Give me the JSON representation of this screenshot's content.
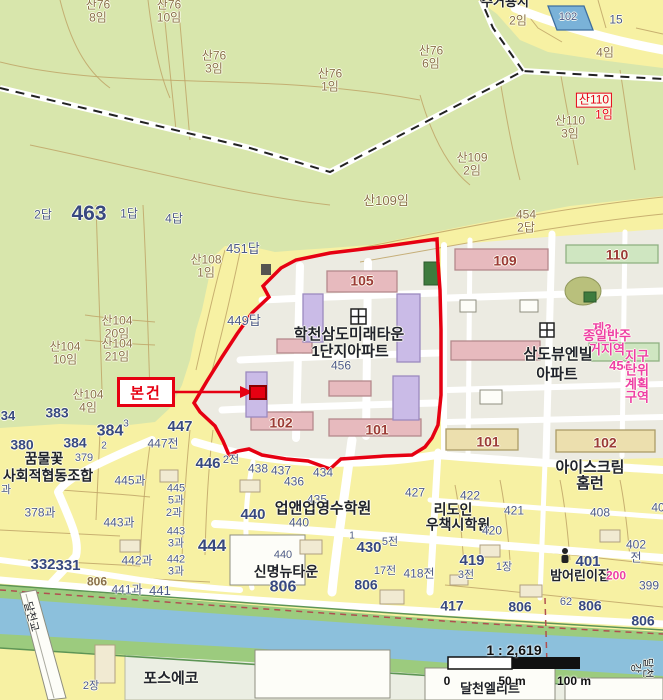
{
  "subject_marker": {
    "label": "본건"
  },
  "scale": {
    "ratio": "1 : 2,619",
    "ticks": [
      "0",
      "50 m",
      "100 m"
    ]
  },
  "colors": {
    "urban": "#f7f1a3",
    "forest": "#d8e6ac",
    "ground": "#ecebe2",
    "road": "#ffffff",
    "parcel_line": "#bfa567",
    "river": "#8cc0dc",
    "bank": "#9ccb7e",
    "industrial": "#ebeee3",
    "boundary_red": "#e60012",
    "building_pink": "#e7babe",
    "building_purple": "#cabbe7",
    "building_green": "#cfe6c1",
    "building_tan": "#ecdfae",
    "building_darkgreen": "#3e7b3e",
    "building_blue": "#7ab2d8",
    "label_blue": "#38497f",
    "label_blue_small": "#4d5a88",
    "label_brown": "#8a7049",
    "label_black": "#20232b",
    "label_red": "#e60012",
    "label_pink": "#ee3fa5",
    "label_building": "#9b3b36"
  },
  "map_labels": [
    {
      "t": "산76\n8임",
      "x": 98,
      "y": 11,
      "c": "brown"
    },
    {
      "t": "산76\n10임",
      "x": 169,
      "y": 11,
      "c": "brown"
    },
    {
      "t": "주거용지",
      "x": 505,
      "y": 2,
      "c": "black",
      "b": 1,
      "s": 13
    },
    {
      "t": "2임",
      "x": 518,
      "y": 21,
      "c": "brown"
    },
    {
      "t": "102",
      "x": 568,
      "y": 18,
      "c": "bluesm",
      "s": 11
    },
    {
      "t": "15",
      "x": 616,
      "y": 20,
      "c": "bluesm",
      "s": 12
    },
    {
      "t": "4임",
      "x": 605,
      "y": 53,
      "c": "brown"
    },
    {
      "t": "산76\n6임",
      "x": 431,
      "y": 57,
      "c": "brown"
    },
    {
      "t": "산76\n3임",
      "x": 214,
      "y": 62,
      "c": "brown"
    },
    {
      "t": "산76\n1임",
      "x": 330,
      "y": 80,
      "c": "brown"
    },
    {
      "t": "산110",
      "x": 594,
      "y": 100,
      "c": "red",
      "box": 1,
      "s": 12
    },
    {
      "t": "1임",
      "x": 604,
      "y": 115,
      "c": "red",
      "s": 12
    },
    {
      "t": "산110\n3임",
      "x": 570,
      "y": 127,
      "c": "brown"
    },
    {
      "t": "산109\n2임",
      "x": 472,
      "y": 164,
      "c": "brown"
    },
    {
      "t": "산109임",
      "x": 386,
      "y": 201,
      "c": "brown",
      "s": 13
    },
    {
      "t": "2답",
      "x": 43,
      "y": 215,
      "c": "bluesm"
    },
    {
      "t": "463",
      "x": 89,
      "y": 214,
      "c": "blue",
      "b": 1,
      "s": 21
    },
    {
      "t": "1답",
      "x": 129,
      "y": 214,
      "c": "bluesm"
    },
    {
      "t": "4답",
      "x": 174,
      "y": 219,
      "c": "bluesm"
    },
    {
      "t": "454\n2답",
      "x": 526,
      "y": 221,
      "c": "brown"
    },
    {
      "t": "451답",
      "x": 243,
      "y": 249,
      "c": "bluesm",
      "s": 13
    },
    {
      "t": "산108\n1임",
      "x": 206,
      "y": 266,
      "c": "brown"
    },
    {
      "t": "449답",
      "x": 244,
      "y": 321,
      "c": "bluesm",
      "s": 13
    },
    {
      "t": "105",
      "x": 362,
      "y": 281,
      "c": "bldg",
      "b": 1,
      "s": 14
    },
    {
      "t": "109",
      "x": 505,
      "y": 261,
      "c": "bldg",
      "b": 1,
      "s": 14
    },
    {
      "t": "110",
      "x": 617,
      "y": 255,
      "c": "bldg",
      "b": 1,
      "s": 14
    },
    {
      "t": "학천삼도미래타운",
      "x": 349,
      "y": 335,
      "c": "black",
      "b": 1,
      "s": 15
    },
    {
      "t": "1단지아파트",
      "x": 350,
      "y": 352,
      "c": "black",
      "b": 1,
      "s": 15
    },
    {
      "t": "456",
      "x": 341,
      "y": 366,
      "c": "bluesm"
    },
    {
      "t": "산104\n20임",
      "x": 117,
      "y": 327,
      "c": "brown"
    },
    {
      "t": "산104\n21임",
      "x": 117,
      "y": 350,
      "c": "brown"
    },
    {
      "t": "산104\n10임",
      "x": 65,
      "y": 353,
      "c": "brown"
    },
    {
      "t": "제3",
      "x": 602,
      "y": 329,
      "c": "pink",
      "b": 1,
      "s": 13
    },
    {
      "t": "종일반주거지역",
      "x": 607,
      "y": 343,
      "c": "pink",
      "b": 1,
      "s": 13
    },
    {
      "t": "삼도뷰엔빌",
      "x": 558,
      "y": 355,
      "c": "black",
      "b": 1,
      "s": 15
    },
    {
      "t": "454",
      "x": 620,
      "y": 366,
      "c": "pink",
      "b": 1,
      "s": 13
    },
    {
      "t": "아파트",
      "x": 557,
      "y": 375,
      "c": "black",
      "b": 1,
      "s": 15
    },
    {
      "t": "지구단위계획구역",
      "x": 637,
      "y": 377,
      "c": "pink",
      "b": 1,
      "s": 13
    },
    {
      "t": "산104\n4임",
      "x": 88,
      "y": 401,
      "c": "brown"
    },
    {
      "t": "34",
      "x": 8,
      "y": 416,
      "c": "blue",
      "b": 1,
      "s": 13
    },
    {
      "t": "383",
      "x": 57,
      "y": 413,
      "c": "blue",
      "b": 1,
      "s": 14
    },
    {
      "t": "384",
      "x": 110,
      "y": 432,
      "c": "blue",
      "b": 1,
      "s": 16
    },
    {
      "t": "3",
      "x": 126,
      "y": 425,
      "c": "bluesm",
      "s": 10
    },
    {
      "t": "2",
      "x": 104,
      "y": 447,
      "c": "bluesm",
      "s": 10
    },
    {
      "t": "380",
      "x": 22,
      "y": 445,
      "c": "blue",
      "b": 1,
      "s": 14
    },
    {
      "t": "384",
      "x": 75,
      "y": 443,
      "c": "blue",
      "b": 1,
      "s": 14
    },
    {
      "t": "447",
      "x": 180,
      "y": 427,
      "c": "blue",
      "b": 1,
      "s": 15
    },
    {
      "t": "447전",
      "x": 163,
      "y": 444,
      "c": "bluesm"
    },
    {
      "t": "446",
      "x": 208,
      "y": 464,
      "c": "blue",
      "b": 1,
      "s": 15
    },
    {
      "t": "2전",
      "x": 231,
      "y": 461,
      "c": "bluesm",
      "s": 11
    },
    {
      "t": "438",
      "x": 258,
      "y": 469,
      "c": "bluesm"
    },
    {
      "t": "437",
      "x": 281,
      "y": 471,
      "c": "bluesm"
    },
    {
      "t": "436",
      "x": 294,
      "y": 482,
      "c": "bluesm"
    },
    {
      "t": "434",
      "x": 323,
      "y": 473,
      "c": "bluesm"
    },
    {
      "t": "435",
      "x": 317,
      "y": 500,
      "c": "bluesm"
    },
    {
      "t": "꿈물꽃",
      "x": 44,
      "y": 459,
      "c": "black",
      "b": 1,
      "s": 14
    },
    {
      "t": "379",
      "x": 84,
      "y": 459,
      "c": "bluesm",
      "s": 11
    },
    {
      "t": "사회적협동조합",
      "x": 48,
      "y": 476,
      "c": "black",
      "b": 1,
      "s": 14
    },
    {
      "t": "445과",
      "x": 130,
      "y": 481,
      "c": "bluesm"
    },
    {
      "t": "과",
      "x": 6,
      "y": 491,
      "c": "bluesm",
      "s": 11
    },
    {
      "t": "445\n5과",
      "x": 176,
      "y": 495,
      "c": "bluesm",
      "s": 11
    },
    {
      "t": "2과",
      "x": 174,
      "y": 514,
      "c": "bluesm",
      "s": 11
    },
    {
      "t": "378과",
      "x": 40,
      "y": 513,
      "c": "bluesm"
    },
    {
      "t": "업앤업영수학원",
      "x": 323,
      "y": 509,
      "c": "black",
      "b": 1,
      "s": 15
    },
    {
      "t": "440",
      "x": 299,
      "y": 523,
      "c": "bluesm"
    },
    {
      "t": "440",
      "x": 253,
      "y": 515,
      "c": "blue",
      "b": 1,
      "s": 15
    },
    {
      "t": "427",
      "x": 415,
      "y": 493,
      "c": "bluesm"
    },
    {
      "t": "아이스크림홈런",
      "x": 590,
      "y": 476,
      "c": "black",
      "b": 1,
      "s": 15
    },
    {
      "t": "422",
      "x": 470,
      "y": 496,
      "c": "bluesm"
    },
    {
      "t": "리도인",
      "x": 453,
      "y": 510,
      "c": "black",
      "b": 1,
      "s": 14
    },
    {
      "t": "우책시학원",
      "x": 458,
      "y": 525,
      "c": "black",
      "b": 1,
      "s": 14
    },
    {
      "t": "421",
      "x": 514,
      "y": 511,
      "c": "bluesm"
    },
    {
      "t": "420",
      "x": 492,
      "y": 531,
      "c": "bluesm"
    },
    {
      "t": "408",
      "x": 600,
      "y": 513,
      "c": "bluesm"
    },
    {
      "t": "40",
      "x": 658,
      "y": 508,
      "c": "bluesm"
    },
    {
      "t": "443과",
      "x": 119,
      "y": 523,
      "c": "bluesm"
    },
    {
      "t": "443\n3과",
      "x": 176,
      "y": 538,
      "c": "bluesm",
      "s": 11
    },
    {
      "t": "444",
      "x": 212,
      "y": 546,
      "c": "blue",
      "b": 1,
      "s": 17
    },
    {
      "t": "442과",
      "x": 137,
      "y": 561,
      "c": "bluesm"
    },
    {
      "t": "442\n3과",
      "x": 176,
      "y": 566,
      "c": "bluesm",
      "s": 11
    },
    {
      "t": "332",
      "x": 43,
      "y": 565,
      "c": "blue",
      "b": 1,
      "s": 15
    },
    {
      "t": "331",
      "x": 68,
      "y": 566,
      "c": "blue",
      "b": 1,
      "s": 15
    },
    {
      "t": "440",
      "x": 283,
      "y": 556,
      "c": "bluesm",
      "s": 11
    },
    {
      "t": "신명뉴타운",
      "x": 286,
      "y": 572,
      "c": "black",
      "b": 1,
      "s": 14
    },
    {
      "t": "806",
      "x": 283,
      "y": 588,
      "c": "blue",
      "b": 1,
      "s": 16
    },
    {
      "t": "806",
      "x": 97,
      "y": 582,
      "c": "brown",
      "b": 1,
      "s": 12
    },
    {
      "t": "441과",
      "x": 127,
      "y": 590,
      "c": "bluesm"
    },
    {
      "t": "441",
      "x": 160,
      "y": 591,
      "c": "bluesm",
      "s": 13
    },
    {
      "t": "1",
      "x": 352,
      "y": 537,
      "c": "bluesm",
      "s": 10
    },
    {
      "t": "430",
      "x": 369,
      "y": 548,
      "c": "blue",
      "b": 1,
      "s": 15
    },
    {
      "t": "5전",
      "x": 390,
      "y": 543,
      "c": "bluesm",
      "s": 11
    },
    {
      "t": "17전",
      "x": 385,
      "y": 572,
      "c": "bluesm",
      "s": 11
    },
    {
      "t": "418전",
      "x": 419,
      "y": 574,
      "c": "bluesm"
    },
    {
      "t": "419",
      "x": 472,
      "y": 561,
      "c": "blue",
      "b": 1,
      "s": 15
    },
    {
      "t": "3전",
      "x": 466,
      "y": 576,
      "c": "bluesm",
      "s": 11
    },
    {
      "t": "401",
      "x": 588,
      "y": 562,
      "c": "blue",
      "b": 1,
      "s": 15
    },
    {
      "t": "1장",
      "x": 504,
      "y": 568,
      "c": "bluesm",
      "s": 11
    },
    {
      "t": "밤어린이집",
      "x": 580,
      "y": 576,
      "c": "black",
      "b": 1,
      "s": 13
    },
    {
      "t": "402전",
      "x": 636,
      "y": 551,
      "c": "bluesm"
    },
    {
      "t": "200",
      "x": 616,
      "y": 576,
      "c": "pink",
      "b": 1,
      "s": 12
    },
    {
      "t": "399",
      "x": 649,
      "y": 586,
      "c": "bluesm"
    },
    {
      "t": "417",
      "x": 452,
      "y": 606,
      "c": "blue",
      "b": 1,
      "s": 14
    },
    {
      "t": "806",
      "x": 520,
      "y": 607,
      "c": "blue",
      "b": 1,
      "s": 14
    },
    {
      "t": "62",
      "x": 566,
      "y": 603,
      "c": "bluesm",
      "s": 11
    },
    {
      "t": "806",
      "x": 590,
      "y": 606,
      "c": "blue",
      "b": 1,
      "s": 14
    },
    {
      "t": "806",
      "x": 366,
      "y": 585,
      "c": "blue",
      "b": 1,
      "s": 14
    },
    {
      "t": "806",
      "x": 643,
      "y": 621,
      "c": "blue",
      "b": 1,
      "s": 14
    },
    {
      "t": "102",
      "x": 281,
      "y": 423,
      "c": "bldg",
      "b": 1,
      "s": 14
    },
    {
      "t": "101",
      "x": 377,
      "y": 430,
      "c": "bldg",
      "b": 1,
      "s": 14
    },
    {
      "t": "101",
      "x": 488,
      "y": 442,
      "c": "bldg",
      "b": 1,
      "s": 14
    },
    {
      "t": "102",
      "x": 605,
      "y": 443,
      "c": "bldg",
      "b": 1,
      "s": 14
    },
    {
      "t": "달천교",
      "x": 30,
      "y": 617,
      "c": "black",
      "s": 11,
      "r": 75
    },
    {
      "t": "달천강",
      "x": 641,
      "y": 668,
      "c": "black",
      "s": 11,
      "r": 90
    },
    {
      "t": "포스에코",
      "x": 171,
      "y": 679,
      "c": "black",
      "b": 1,
      "s": 15
    },
    {
      "t": "2장",
      "x": 91,
      "y": 687,
      "c": "bluesm",
      "s": 11
    },
    {
      "t": "달천엘리트",
      "x": 490,
      "y": 689,
      "c": "black",
      "b": 1,
      "s": 13
    }
  ]
}
